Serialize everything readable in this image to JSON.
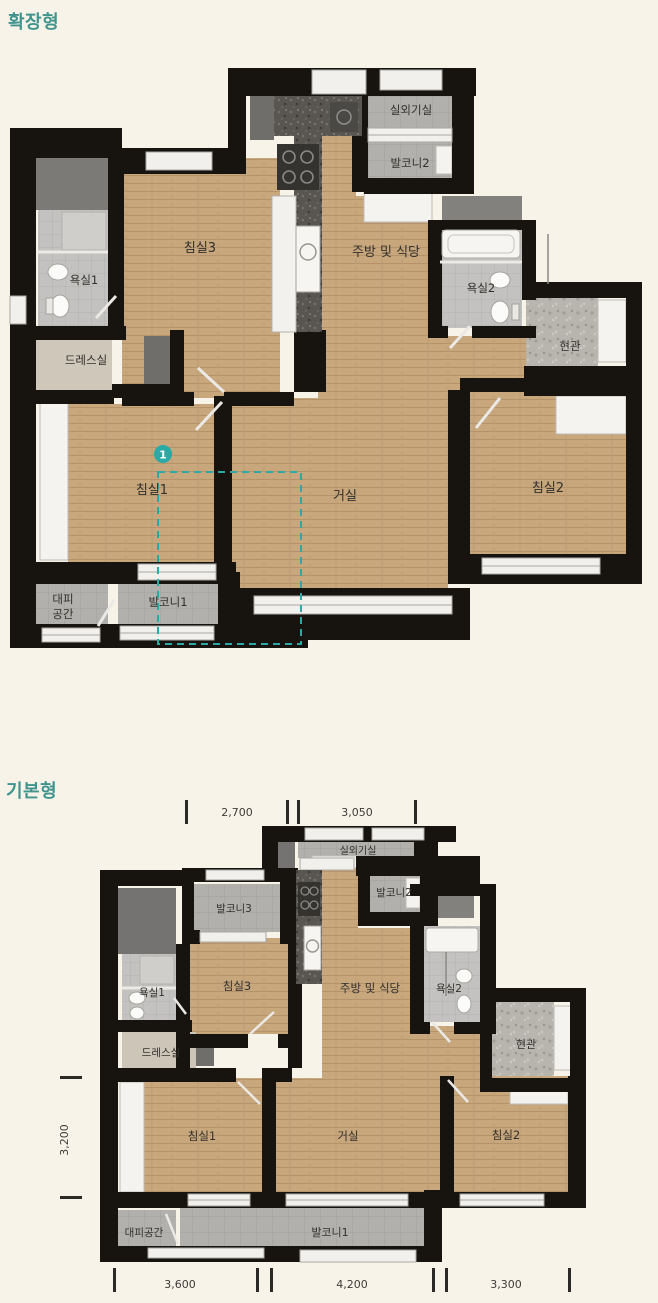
{
  "page": {
    "background_color": "#f8f3e8",
    "accent_teal": "#2aaaa5",
    "wall_color": "#17140f",
    "wood_color": "#c8a77d",
    "balcony_tile_color": "#b2b0ac"
  },
  "extended": {
    "title": "확장형",
    "labels": {
      "outdoor_unit": "실외기실",
      "balcony2": "발코니2",
      "bedroom3": "침실3",
      "kitchen_dining": "주방 및 식당",
      "bath1": "욕실1",
      "bath2": "욕실2",
      "dress_room": "드레스실",
      "entrance": "현관",
      "bedroom1": "침실1",
      "living_room": "거실",
      "bedroom2": "침실2",
      "shelter_line1": "대피",
      "shelter_line2": "공간",
      "balcony1": "발코니1",
      "marker_number": "1"
    }
  },
  "basic": {
    "title": "기본형",
    "labels": {
      "outdoor_unit": "실외기실",
      "balcony3": "발코니3",
      "balcony2": "발코니2",
      "bedroom3": "침실3",
      "kitchen_dining": "주방 및 식당",
      "bath1": "욕실1",
      "bath2": "욕실2",
      "dress_room": "드레스실",
      "entrance": "현관",
      "bedroom1": "침실1",
      "living_room": "거실",
      "bedroom2": "침실2",
      "shelter": "대피공간",
      "balcony1": "발코니1"
    },
    "dimensions": {
      "top_width_left": "2,700",
      "top_width_right": "3,050",
      "side_height": "3,200",
      "bottom_width_left": "3,600",
      "bottom_width_center": "4,200",
      "bottom_width_right": "3,300"
    }
  }
}
